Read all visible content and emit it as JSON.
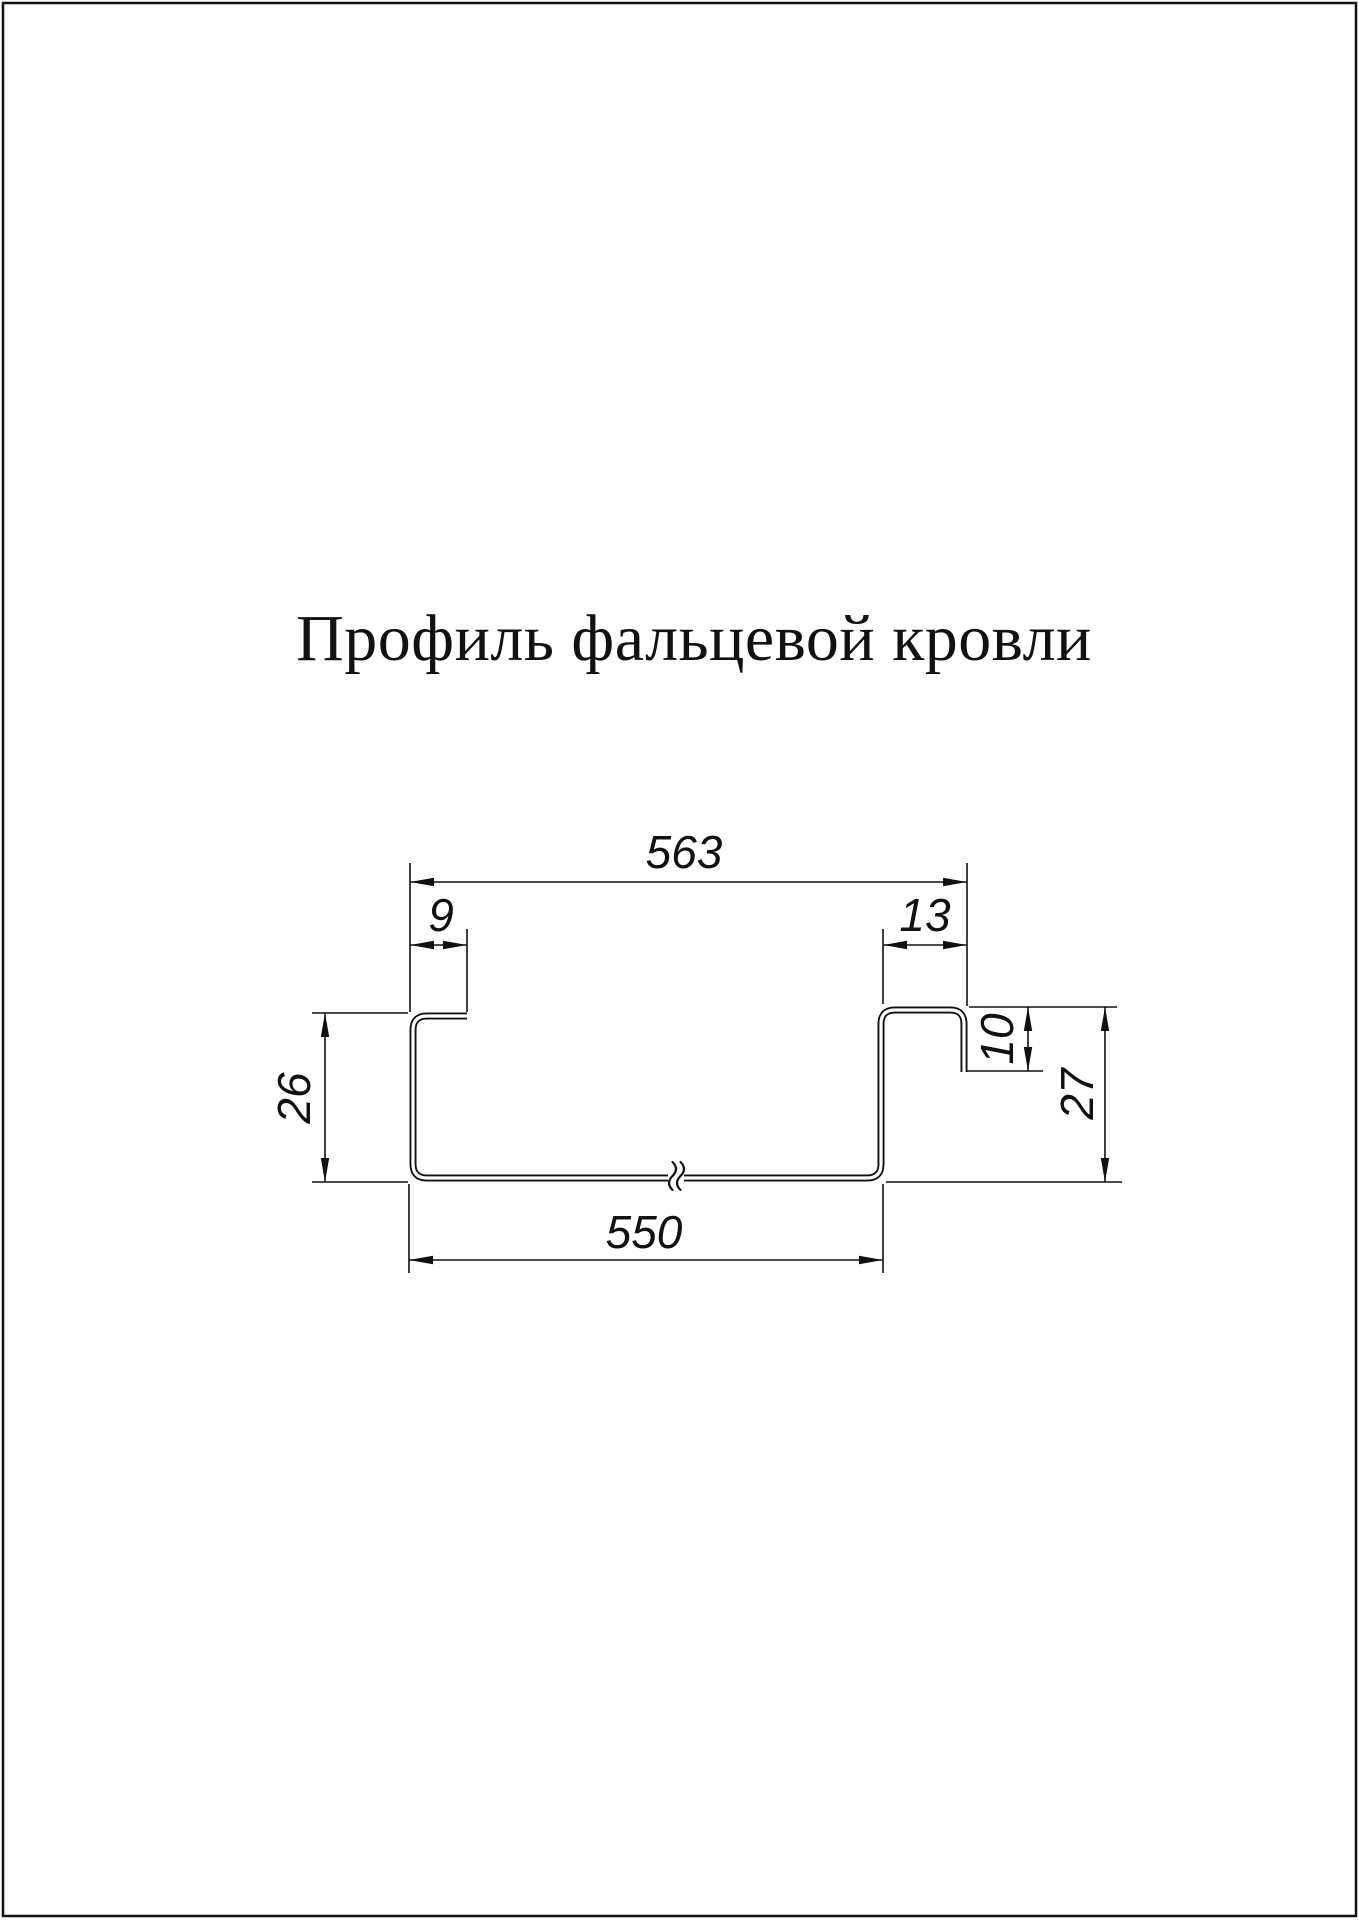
{
  "page": {
    "title": "Профиль фальцевой кровли",
    "background": "#ffffff",
    "border_color": "#000000",
    "line_color": "#111111"
  },
  "drawing": {
    "type": "technical cross-section of standing seam roofing profile",
    "units_shown": false,
    "dimensions": {
      "top_overall_width": "563",
      "left_flange_width": "9",
      "right_seam_width": "13",
      "left_height": "26",
      "seam_leg_height": "10",
      "right_height": "27",
      "bottom_width": "550"
    }
  }
}
